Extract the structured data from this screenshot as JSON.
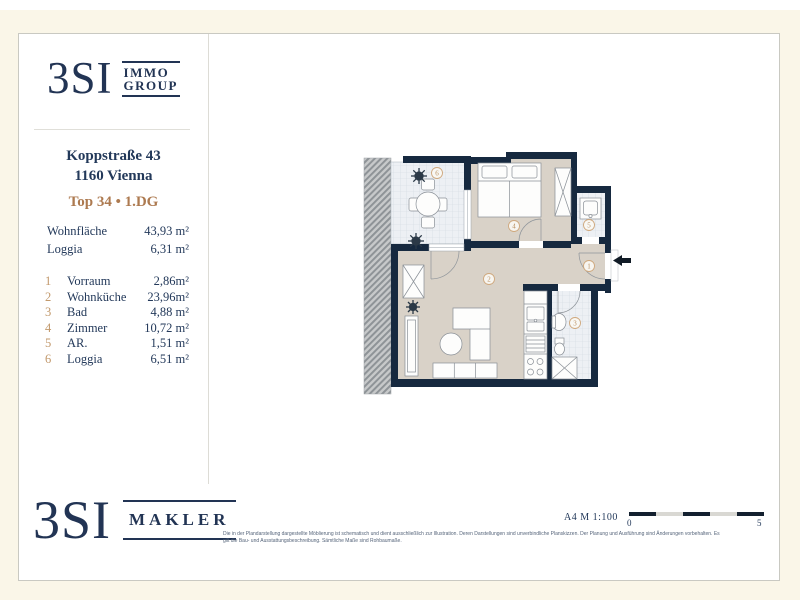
{
  "colors": {
    "navy_brand": "#223454",
    "wall_navy": "#16293f",
    "tan_accent": "#ad7a50",
    "gold_numbers": "#c2996c",
    "floor_beige": "#d9d2c8",
    "background_cream": "#faf6e8"
  },
  "sidebar": {
    "logo": {
      "main": "3SI",
      "sub_line1": "IMMO",
      "sub_line2": "GROUP"
    },
    "address_line1": "Koppstraße 43",
    "address_line2": "1160 Vienna",
    "unit": "Top 34 • 1.DG",
    "summary": [
      {
        "label": "Wohnfläche",
        "value": "43,93 m²"
      },
      {
        "label": "Loggia",
        "value": "6,31 m²"
      }
    ],
    "rooms": [
      {
        "no": "1",
        "name": "Vorraum",
        "area": "2,86m²"
      },
      {
        "no": "2",
        "name": "Wohnküche",
        "area": "23,96m²"
      },
      {
        "no": "3",
        "name": "Bad",
        "area": "4,88 m²"
      },
      {
        "no": "4",
        "name": "Zimmer",
        "area": "10,72 m²"
      },
      {
        "no": "5",
        "name": "AR.",
        "area": "1,51 m²"
      },
      {
        "no": "6",
        "name": "Loggia",
        "area": "6,51 m²"
      }
    ]
  },
  "plan": {
    "room_numbers": [
      "1",
      "2",
      "3",
      "4",
      "5",
      "6"
    ]
  },
  "footer": {
    "logo": {
      "main": "3SI",
      "sub": "MAKLER"
    },
    "disclaimer_line1": "Die in der Plandarstellung dargestellte Möblierung ist schematisch und dient ausschließlich zur Illustration. Deren Darstellungen sind unverbindliche Planskizzen. Der Planung und Ausführung sind Änderungen vorbehalten. Es",
    "disclaimer_line2": "gilt die Bau- und Ausstattungsbeschreibung. Sämtliche Maße sind Rohbaumaße.",
    "scale_text": "A4  M 1:100",
    "scale_start": "0",
    "scale_end": "5"
  }
}
